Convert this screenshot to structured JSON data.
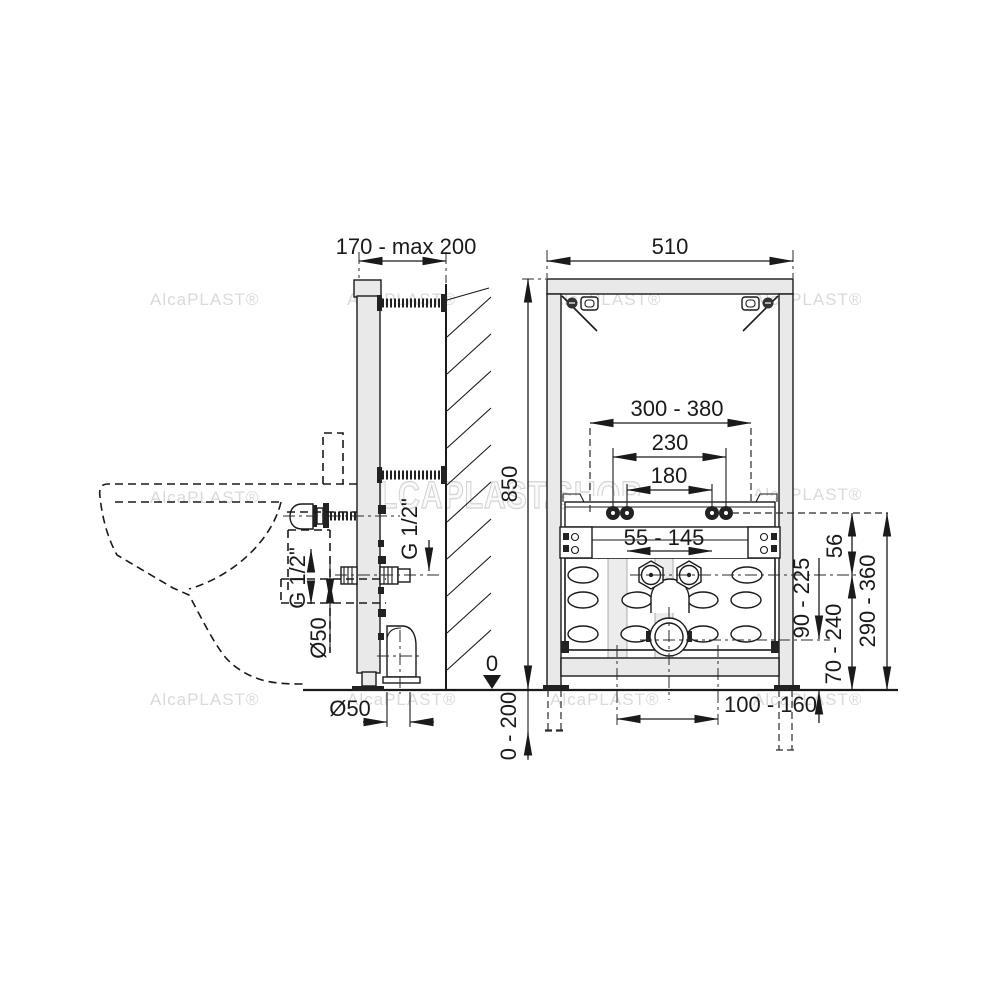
{
  "watermarks": {
    "small": "AlcaPLAST®",
    "big": "ALCAPLAST.SHOP"
  },
  "side_view": {
    "depth_range": "170 - max 200",
    "thread_size_front": "G 1/2\"",
    "thread_size_wall": "G 1/2\"",
    "pipe_dia": "Ø50",
    "outlet_dia": "Ø50"
  },
  "front_view": {
    "frame_width": "510",
    "frame_height": "850",
    "floor_datum": "0",
    "leg_adjust": "0 - 200",
    "stud_spread": "300 - 380",
    "stud_spread_230": "230",
    "stud_spread_180": "180",
    "water_spread": "55 - 145",
    "rim_offset": "56",
    "drain_height": "90 - 225",
    "water_height": "70 - 240",
    "stud_height": "290 - 360",
    "drain_offset": "100 - 160"
  }
}
